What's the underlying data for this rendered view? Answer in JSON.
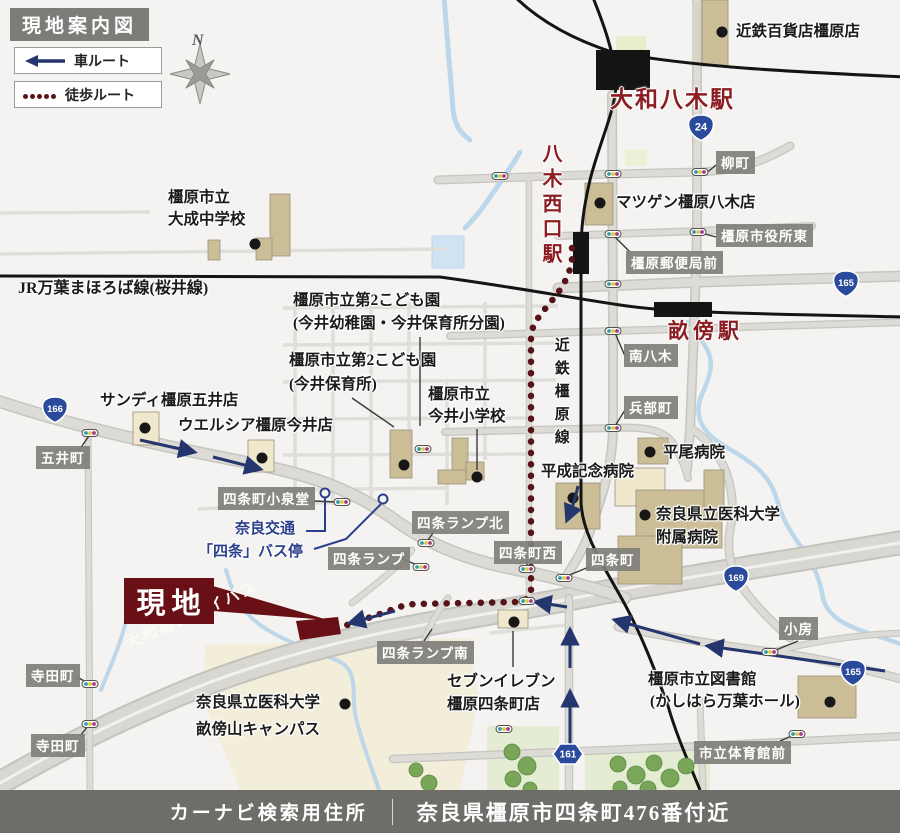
{
  "title": "現地案内図",
  "legend": {
    "car": "車ルート",
    "walk": "徒歩ルート"
  },
  "compass": "N",
  "site_label": "現地",
  "footer": {
    "label": "カーナビ検索用住所",
    "address": "奈良県橿原市四条町476番付近"
  },
  "stations": {
    "yamato_yagi": "大和八木駅",
    "yagi_nishiguchi": "八木西口駅",
    "unebi": "畝傍駅"
  },
  "rails": {
    "jr": "JR万葉まほろば線(桜井線)",
    "kintetsu_kashihara": "近鉄橿原線"
  },
  "roads": {
    "bypass": "大和高田バイパス"
  },
  "shields": {
    "r24": "24",
    "r165n": "165",
    "r166": "166",
    "r169": "169",
    "r165s": "165",
    "r161": "161"
  },
  "boxes": {
    "yanagicho": "柳町",
    "shiyakusho_higashi": "橿原市役所東",
    "yubinkyoku_mae": "橿原郵便局前",
    "minami_yagi": "南八木",
    "hyobucho": "兵部町",
    "goicho": "五井町",
    "koizumido": "四条町小泉堂",
    "ramp_kita": "四条ランプ北",
    "ramp": "四条ランプ",
    "shijocho_nishi": "四条町西",
    "shijocho": "四条町",
    "ramp_minami": "四条ランプ南",
    "obusa": "小房",
    "taiikukan_mae": "市立体育館前",
    "teradacho_n": "寺田町",
    "teradacho_s": "寺田町"
  },
  "pois": {
    "kintetsu_dept": "近鉄百貨店橿原店",
    "matsugen": "マツゲン橿原八木店",
    "taisei_l1": "橿原市立",
    "taisei_l2": "大成中学校",
    "kodomo_bunen_l1": "橿原市立第2こども園",
    "kodomo_bunen_l2": "(今井幼稚園・今井保育所分園)",
    "kodomo_hoiku_l1": "橿原市立第2こども園",
    "kodomo_hoiku_l2": "(今井保育所)",
    "imai_es_l1": "橿原市立",
    "imai_es_l2": "今井小学校",
    "sundi": "サンディ橿原五井店",
    "welcia": "ウエルシア橿原今井店",
    "bus_l1": "奈良交通",
    "bus_l2": "「四条」バス停",
    "heisei": "平成記念病院",
    "hirao": "平尾病院",
    "med_hosp_l1": "奈良県立医科大学",
    "med_hosp_l2": "附属病院",
    "seven_l1": "セブンイレブン",
    "seven_l2": "橿原四条町店",
    "campus_l1": "奈良県立医科大学",
    "campus_l2": "畝傍山キャンパス",
    "library_l1": "橿原市立図書館",
    "library_l2": "(かしはら万葉ホール)"
  },
  "colors": {
    "station_red": "#8b1d22",
    "site_red": "#681016",
    "car_route_blue": "#25356e",
    "walk_route_red": "#571317",
    "shield_blue": "#2a4b9b",
    "box_gray": "#807f7b",
    "road_gray": "#dcdbd6",
    "rail_black": "#141414",
    "river_blue": "#bcd6ea",
    "building_tan": "#cbbd96"
  }
}
